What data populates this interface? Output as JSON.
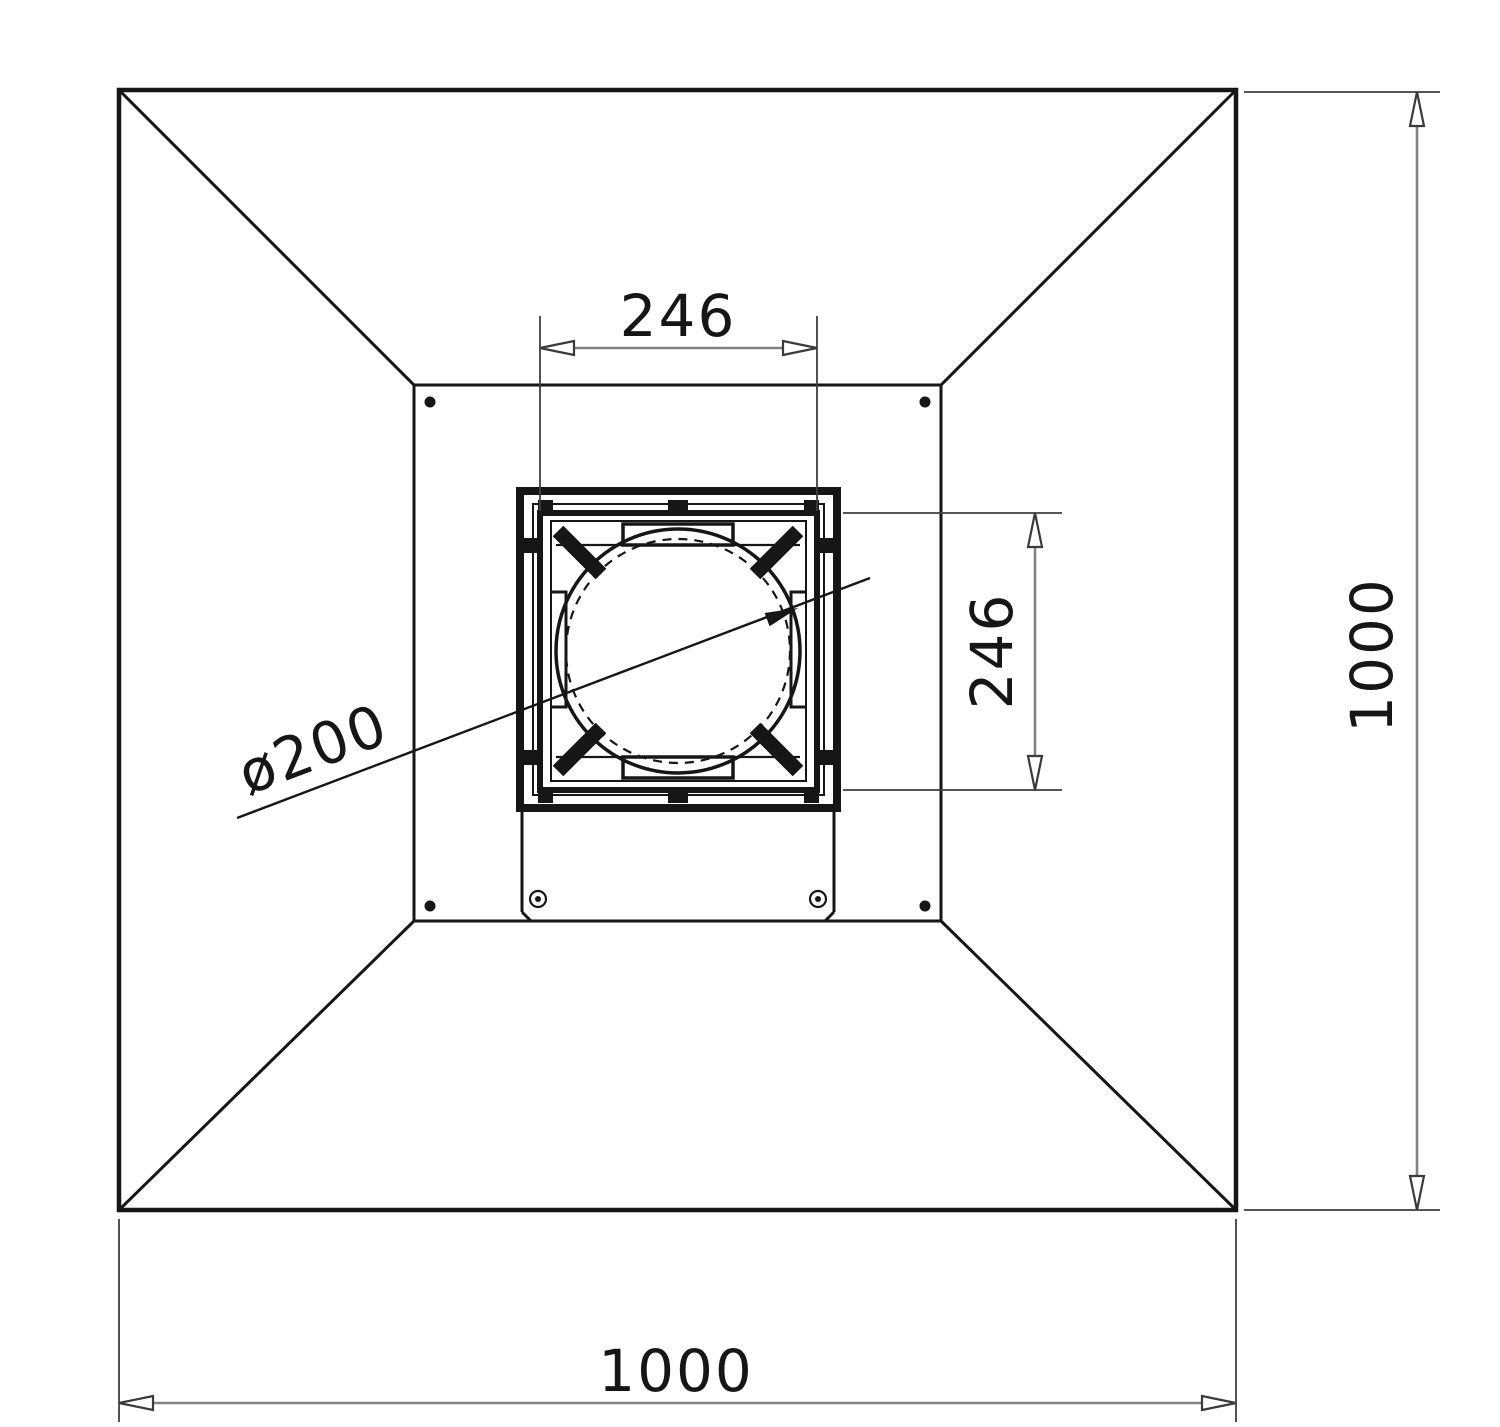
{
  "drawing": {
    "description": "Plan view technical drawing of a square extraction hood with central duct flange",
    "labels": {
      "inner_width": "246",
      "inner_height": "246",
      "spigot_diameter": "ø200",
      "overall_width": "1000",
      "overall_height": "1000"
    },
    "colors": {
      "geometry": "#161616",
      "dimension_line": "#828282",
      "extension_line": "#3f3f3f",
      "background": "#ffffff"
    }
  }
}
